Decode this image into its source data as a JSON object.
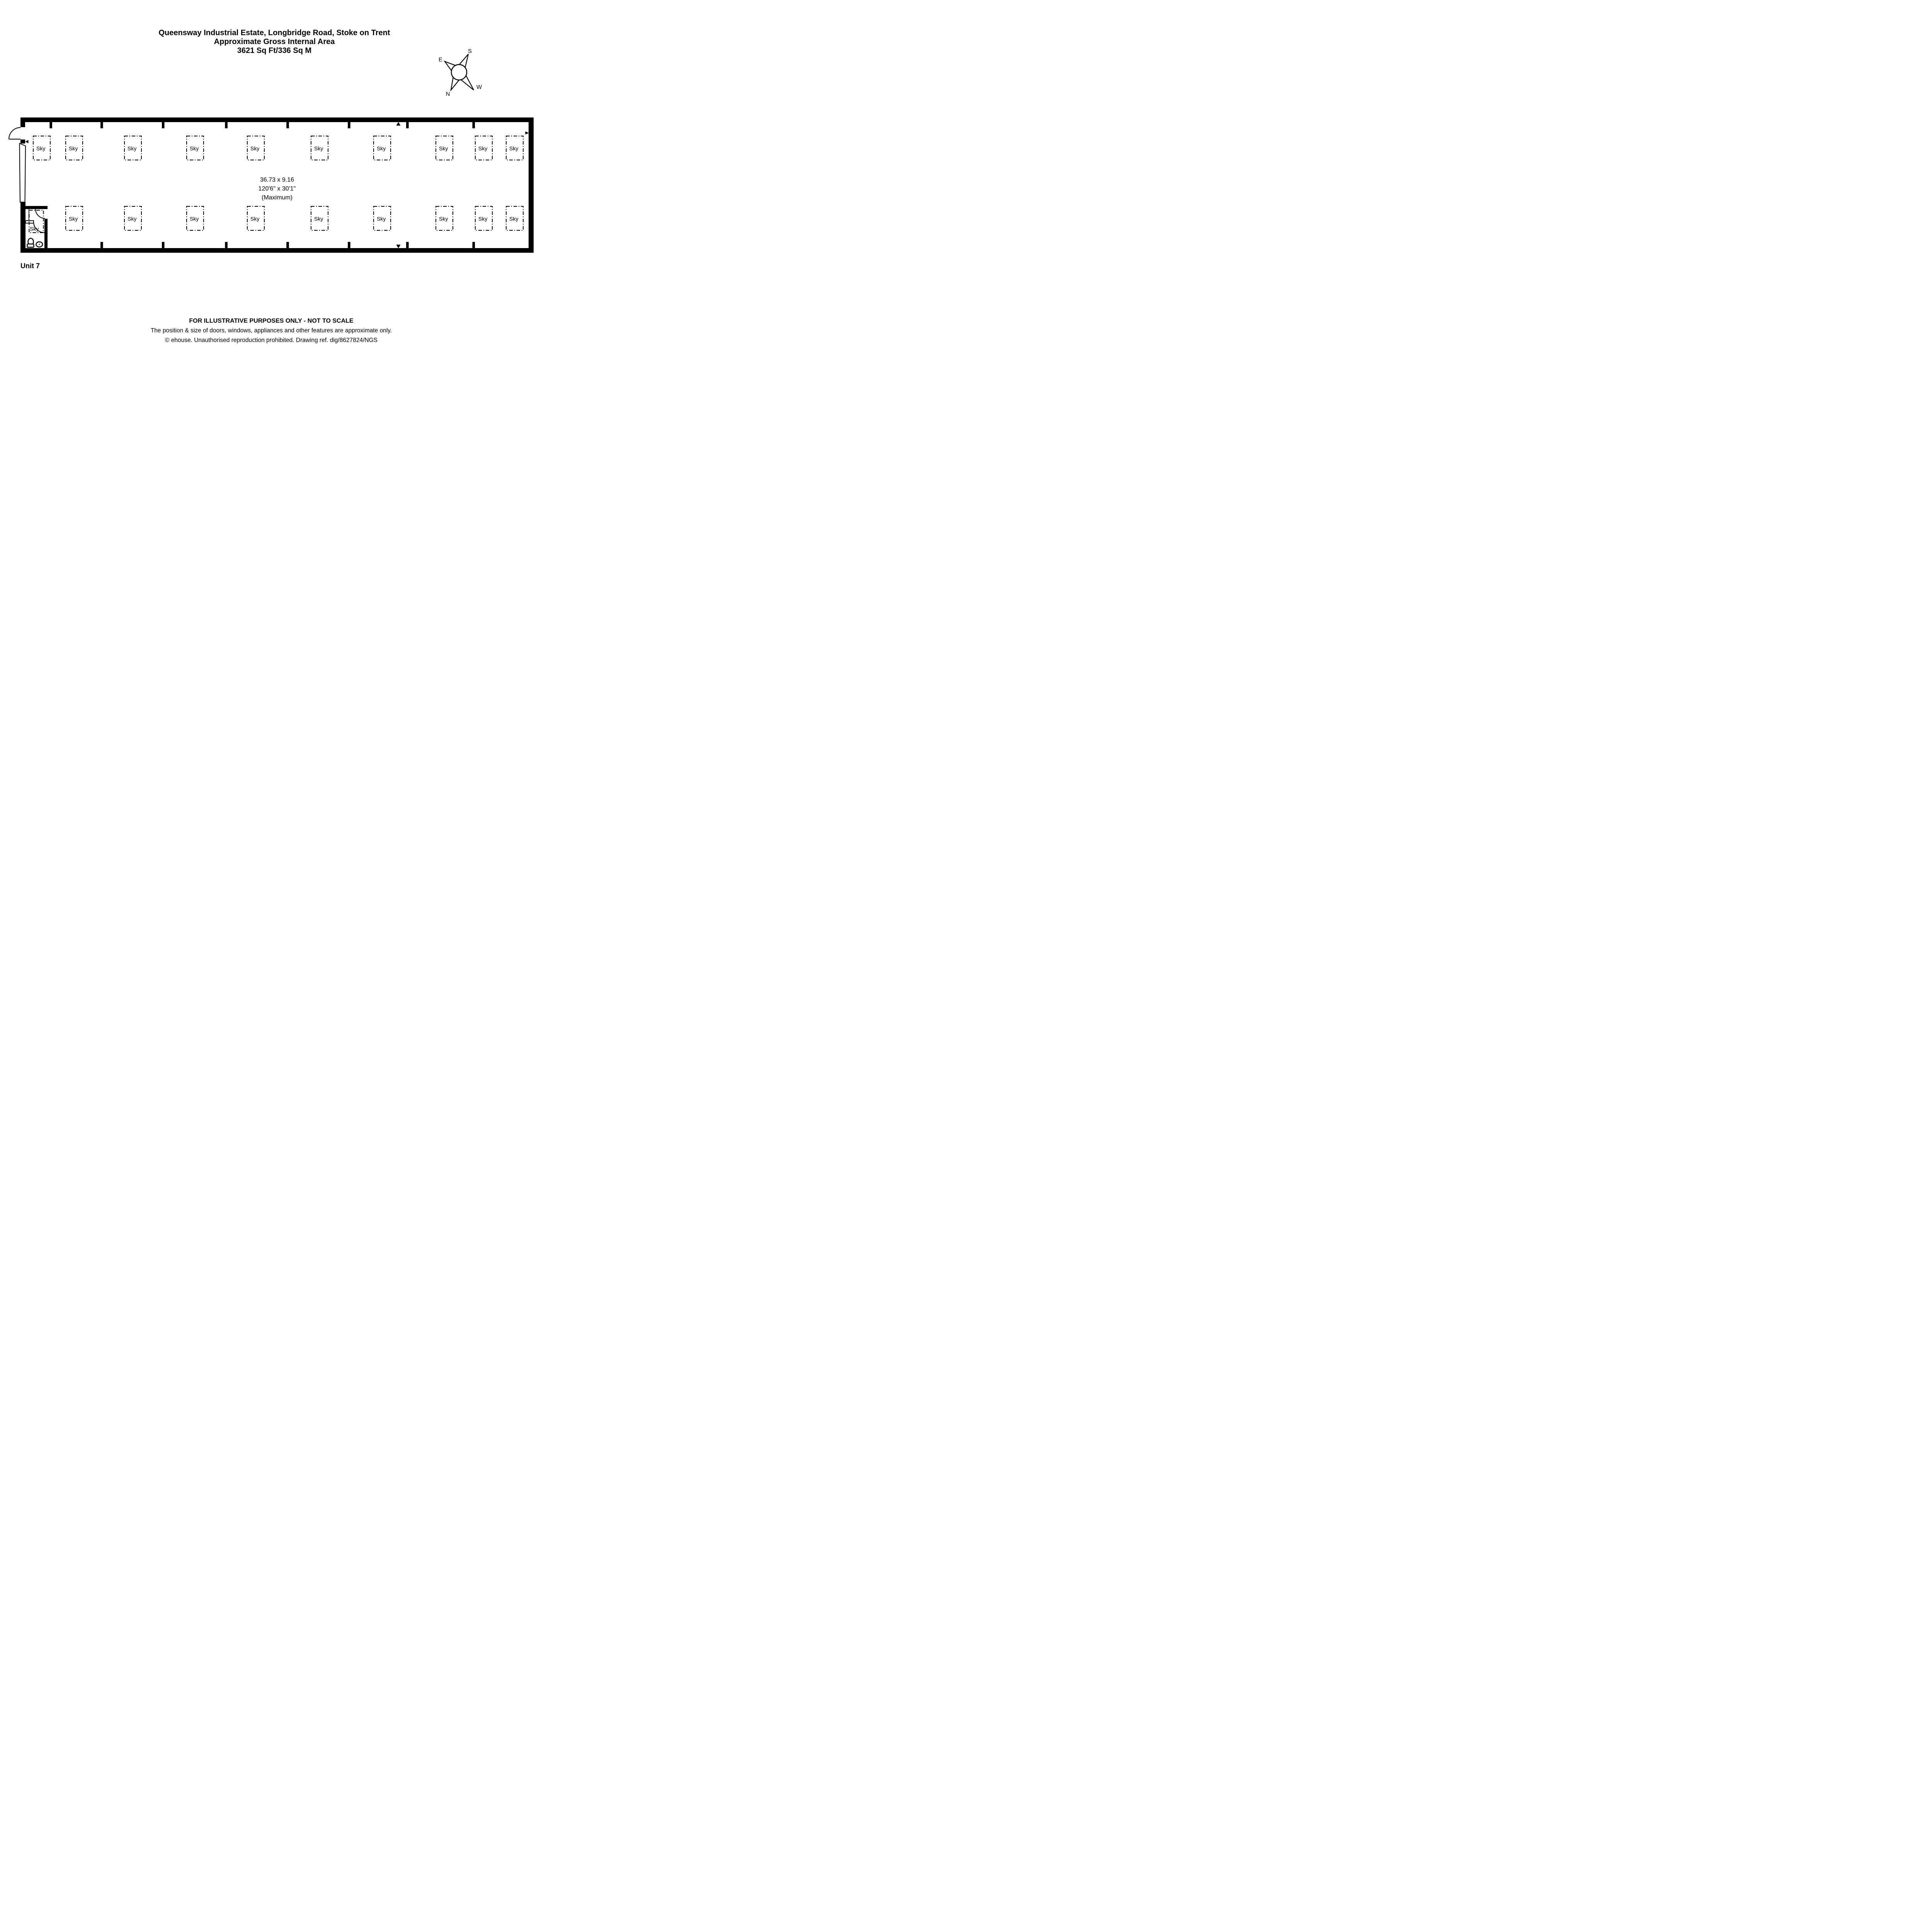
{
  "header": {
    "line1": "Queensway Industrial Estate, Longbridge Road, Stoke on Trent",
    "line2": "Approximate Gross Internal Area",
    "line3": "3621 Sq Ft/336 Sq M"
  },
  "compass": {
    "north": "N",
    "south": "S",
    "east": "E",
    "west": "W"
  },
  "plan": {
    "unit_label": "Unit 7",
    "dimensions": {
      "metric": "36.73 x 9.16",
      "imperial": "120'6\" x 30'1\"",
      "qualifier": "(Maximum)"
    },
    "skylights": {
      "label": "Sky",
      "count_top_row": 10,
      "count_bottom_row": 9,
      "count_wc_lobby": 1
    }
  },
  "footer": {
    "line1": "FOR ILLUSTRATIVE PURPOSES ONLY - NOT TO SCALE",
    "line2": "The position & size of doors, windows, appliances and other features are approximate only.",
    "line3": "© ehouse. Unauthorised reproduction prohibited. Drawing ref. dig/8627824/NGS"
  },
  "colors": {
    "ink": "#000000",
    "background": "#ffffff"
  }
}
